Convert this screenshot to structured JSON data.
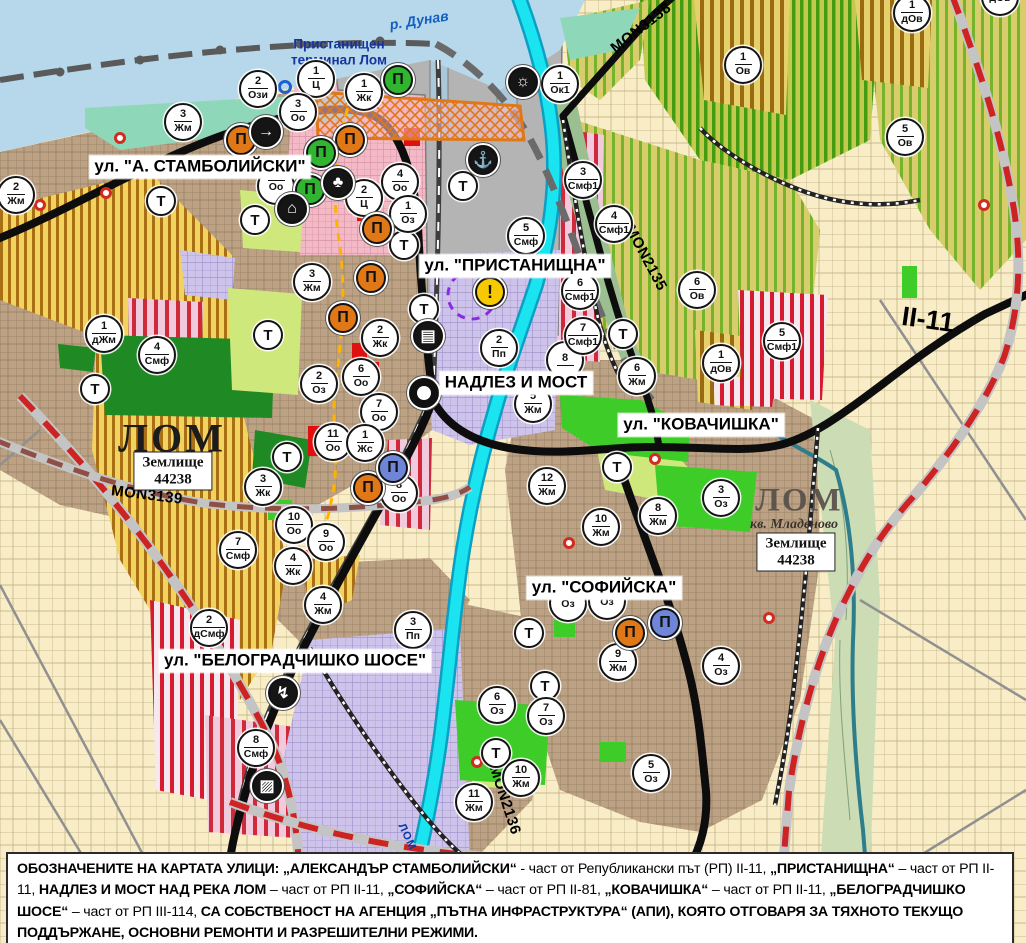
{
  "palette": {
    "water": "#b7d7ea",
    "mint": "#8fd7b9",
    "urban": "#bda185",
    "cream": "#f8edc6",
    "yellow_zone": "#f1d35e",
    "yellow_stripe": "#a86f14",
    "vine": "#d8cd6d",
    "vine_stripe": "#74b32a",
    "vine_dense": "#c3cb4f",
    "vine_dense_stripe": "#459b12",
    "red_stripe": "#d51b30",
    "pink": "#f3bac6",
    "lavender": "#cec3ea",
    "gray_port": "#b4b4b4",
    "park_dark": "#1f8a24",
    "green_bright": "#3ecc28",
    "green_light": "#cfe87c",
    "cyan_river": "#1ae4ef",
    "road_black": "#0d0d0d",
    "road_red_dash": "#ce2323",
    "road_brown_dash": "#8f4f45",
    "marker_orange": "#e07818",
    "marker_green": "#2fb52f",
    "marker_blue": "#6f86d8",
    "warning_yellow": "#f7c900"
  },
  "street_labels": [
    {
      "text": "ул. \"А. СТАМБОЛИЙСКИ\"",
      "x": 200,
      "y": 167
    },
    {
      "text": "ул. \"ПРИСТАНИЩНА\"",
      "x": 515,
      "y": 266
    },
    {
      "text": "НАДЛЕЗ И МОСТ",
      "x": 516,
      "y": 383
    },
    {
      "text": "ул. \"КОВАЧИШКА\"",
      "x": 701,
      "y": 425
    },
    {
      "text": "ул. \"СОФИЙСКА\"",
      "x": 604,
      "y": 588
    },
    {
      "text": "ул. \"БЕЛОГРАДЧИШКО ШОСЕ\"",
      "x": 295,
      "y": 661
    }
  ],
  "map_labels": [
    {
      "text": "р. Дунав",
      "x": 419,
      "y": 20,
      "rot": -9,
      "cls": "lbl-river",
      "name": "river-danube-label"
    },
    {
      "text": "Пристанищен\nтерминал Лом",
      "x": 339,
      "y": 52,
      "rot": 0,
      "cls": "lbl-port",
      "name": "port-terminal-label"
    },
    {
      "text": "MON3138",
      "x": 641,
      "y": 28,
      "rot": -38,
      "cls": "lbl-road",
      "name": "road-label-mon3138"
    },
    {
      "text": "MON2135",
      "x": 646,
      "y": 258,
      "rot": 62,
      "cls": "lbl-road",
      "name": "road-label-mon2135"
    },
    {
      "text": "MON3139",
      "x": 147,
      "y": 495,
      "rot": 7,
      "cls": "lbl-road",
      "name": "road-label-mon3139"
    },
    {
      "text": "MON2136",
      "x": 505,
      "y": 800,
      "rot": 72,
      "cls": "lbl-road",
      "name": "road-label-mon2136"
    },
    {
      "text": "II-11",
      "x": 928,
      "y": 320,
      "rot": 8,
      "cls": "lbl-road-big",
      "name": "road-label-ii-11"
    },
    {
      "text": "ЛОМ",
      "x": 172,
      "y": 438,
      "rot": 0,
      "cls": "lbl-city",
      "name": "city-label-lom"
    },
    {
      "text": "ЛОМ",
      "x": 799,
      "y": 501,
      "rot": 0,
      "cls": "lbl-city2",
      "name": "city-label-lom-mladenovo"
    },
    {
      "text": "кв. Младеново",
      "x": 794,
      "y": 525,
      "rot": 0,
      "cls": "lbl-kv",
      "name": "quarter-label-mladenovo"
    },
    {
      "text": "ЛОМ",
      "x": 407,
      "y": 837,
      "rot": 65,
      "cls": "lbl-riverlom",
      "name": "river-lom-label"
    }
  ],
  "zemlishte_boxes": [
    {
      "line1": "Землище",
      "line2": "44238",
      "x": 173,
      "y": 471
    },
    {
      "line1": "Землище",
      "line2": "44238",
      "x": 796,
      "y": 552
    }
  ],
  "zone_markers": [
    {
      "n": "2",
      "a": "Жм",
      "x": 16,
      "y": 195
    },
    {
      "n": "3",
      "a": "Жм",
      "x": 183,
      "y": 122
    },
    {
      "n": "2",
      "a": "Ози",
      "x": 258,
      "y": 89
    },
    {
      "n": "1",
      "a": "Ц",
      "x": 316,
      "y": 79
    },
    {
      "n": "1",
      "a": "Жк",
      "x": 364,
      "y": 92
    },
    {
      "n": "3",
      "a": "Оо",
      "x": 298,
      "y": 112
    },
    {
      "n": "4",
      "a": "Оо",
      "x": 400,
      "y": 182
    },
    {
      "n": "2",
      "a": "Ц",
      "x": 364,
      "y": 198
    },
    {
      "n": "1",
      "a": "Оз",
      "x": 408,
      "y": 214
    },
    {
      "n": "",
      "a": "Оо",
      "x": 276,
      "y": 186
    },
    {
      "n": "1",
      "a": "дЖм",
      "x": 104,
      "y": 334
    },
    {
      "n": "4",
      "a": "Смф",
      "x": 157,
      "y": 355
    },
    {
      "n": "3",
      "a": "Жм",
      "x": 312,
      "y": 282
    },
    {
      "n": "2",
      "a": "Жк",
      "x": 380,
      "y": 338
    },
    {
      "n": "6",
      "a": "Оо",
      "x": 361,
      "y": 377
    },
    {
      "n": "2",
      "a": "Оз",
      "x": 319,
      "y": 384
    },
    {
      "n": "7",
      "a": "Оо",
      "x": 379,
      "y": 412
    },
    {
      "n": "11",
      "a": "Оо",
      "x": 333,
      "y": 442
    },
    {
      "n": "1",
      "a": "Жс",
      "x": 365,
      "y": 443
    },
    {
      "n": "3",
      "a": "Жк",
      "x": 263,
      "y": 487
    },
    {
      "n": "8",
      "a": "Оо",
      "x": 399,
      "y": 493
    },
    {
      "n": "10",
      "a": "Оо",
      "x": 294,
      "y": 525
    },
    {
      "n": "9",
      "a": "Оо",
      "x": 326,
      "y": 542
    },
    {
      "n": "4",
      "a": "Жк",
      "x": 293,
      "y": 566
    },
    {
      "n": "7",
      "a": "Смф",
      "x": 238,
      "y": 550
    },
    {
      "n": "2",
      "a": "дСмф",
      "x": 209,
      "y": 628
    },
    {
      "n": "4",
      "a": "Жм",
      "x": 323,
      "y": 605
    },
    {
      "n": "3",
      "a": "Пп",
      "x": 413,
      "y": 630
    },
    {
      "n": "8",
      "a": "Смф",
      "x": 256,
      "y": 748
    },
    {
      "n": "5",
      "a": "Смф",
      "x": 526,
      "y": 236
    },
    {
      "n": "2",
      "a": "Пп",
      "x": 499,
      "y": 348
    },
    {
      "n": "8",
      "a": "",
      "x": 565,
      "y": 360
    },
    {
      "n": "5",
      "a": "Жм",
      "x": 533,
      "y": 404
    },
    {
      "n": "6",
      "a": "Жм",
      "x": 637,
      "y": 376
    },
    {
      "n": "12",
      "a": "Жм",
      "x": 547,
      "y": 486
    },
    {
      "n": "10",
      "a": "Жм",
      "x": 601,
      "y": 527
    },
    {
      "n": "8",
      "a": "Жм",
      "x": 658,
      "y": 516
    },
    {
      "n": "3",
      "a": "Оз",
      "x": 721,
      "y": 498
    },
    {
      "n": "",
      "a": "Оз",
      "x": 568,
      "y": 603
    },
    {
      "n": "",
      "a": "Оз",
      "x": 607,
      "y": 601
    },
    {
      "n": "9",
      "a": "Жм",
      "x": 618,
      "y": 662
    },
    {
      "n": "4",
      "a": "Оз",
      "x": 721,
      "y": 666
    },
    {
      "n": "6",
      "a": "Оз",
      "x": 497,
      "y": 705
    },
    {
      "n": "7",
      "a": "Оз",
      "x": 546,
      "y": 716
    },
    {
      "n": "10",
      "a": "Жм",
      "x": 521,
      "y": 778
    },
    {
      "n": "11",
      "a": "Жм",
      "x": 474,
      "y": 802
    },
    {
      "n": "5",
      "a": "Оз",
      "x": 651,
      "y": 773
    },
    {
      "n": "1",
      "a": "Ок1",
      "x": 560,
      "y": 84
    },
    {
      "n": "3",
      "a": "Смф1",
      "x": 583,
      "y": 180
    },
    {
      "n": "4",
      "a": "Смф1",
      "x": 614,
      "y": 224
    },
    {
      "n": "6",
      "a": "Смф1",
      "x": 580,
      "y": 291
    },
    {
      "n": "7",
      "a": "Смф1",
      "x": 583,
      "y": 336
    },
    {
      "n": "5",
      "a": "Смф1",
      "x": 782,
      "y": 341
    },
    {
      "n": "6",
      "a": "Ов",
      "x": 697,
      "y": 290
    },
    {
      "n": "1",
      "a": "дОв",
      "x": 721,
      "y": 363
    },
    {
      "n": "1",
      "a": "Ов",
      "x": 743,
      "y": 65
    },
    {
      "n": "5",
      "a": "Ов",
      "x": 905,
      "y": 137
    },
    {
      "n": "1",
      "a": "дОв",
      "x": 912,
      "y": 13
    },
    {
      "n": "",
      "a": "дОв",
      "x": 1000,
      "y": -3
    }
  ],
  "t_markers": [
    {
      "x": 161,
      "y": 201
    },
    {
      "x": 255,
      "y": 220
    },
    {
      "x": 268,
      "y": 335
    },
    {
      "x": 95,
      "y": 389
    },
    {
      "x": 287,
      "y": 457
    },
    {
      "x": 404,
      "y": 245
    },
    {
      "x": 424,
      "y": 309
    },
    {
      "x": 463,
      "y": 186
    },
    {
      "x": 623,
      "y": 334
    },
    {
      "x": 617,
      "y": 467
    },
    {
      "x": 529,
      "y": 633
    },
    {
      "x": 545,
      "y": 686
    },
    {
      "x": 496,
      "y": 753
    }
  ],
  "poi_icons": [
    {
      "kind": "landmark",
      "variant": "orange",
      "x": 241,
      "y": 140
    },
    {
      "kind": "landmark",
      "variant": "orange",
      "x": 350,
      "y": 140
    },
    {
      "kind": "landmark",
      "variant": "orange",
      "x": 377,
      "y": 229
    },
    {
      "kind": "landmark",
      "variant": "orange",
      "x": 371,
      "y": 278
    },
    {
      "kind": "landmark",
      "variant": "orange",
      "x": 343,
      "y": 318
    },
    {
      "kind": "landmark",
      "variant": "orange",
      "x": 368,
      "y": 488
    },
    {
      "kind": "landmark",
      "variant": "orange",
      "x": 630,
      "y": 633
    },
    {
      "kind": "landmark",
      "variant": "green",
      "x": 398,
      "y": 80
    },
    {
      "kind": "landmark",
      "variant": "green",
      "x": 321,
      "y": 153
    },
    {
      "kind": "landmark",
      "variant": "green",
      "x": 310,
      "y": 190
    },
    {
      "kind": "landmark",
      "variant": "blue",
      "x": 393,
      "y": 468
    },
    {
      "kind": "landmark",
      "variant": "blue",
      "x": 665,
      "y": 623
    },
    {
      "kind": "key",
      "variant": "black",
      "x": 266,
      "y": 132
    },
    {
      "kind": "trefoil",
      "variant": "black",
      "x": 338,
      "y": 183
    },
    {
      "kind": "mountain",
      "variant": "black",
      "x": 292,
      "y": 209
    },
    {
      "kind": "anchor",
      "variant": "black",
      "x": 483,
      "y": 160
    },
    {
      "kind": "sun",
      "variant": "black",
      "x": 523,
      "y": 82
    },
    {
      "kind": "bus",
      "variant": "black",
      "x": 428,
      "y": 336
    },
    {
      "kind": "lightning",
      "variant": "black",
      "x": 283,
      "y": 693
    },
    {
      "kind": "railcross",
      "variant": "black",
      "x": 267,
      "y": 786
    },
    {
      "kind": "warning",
      "variant": "warning",
      "x": 490,
      "y": 292
    },
    {
      "kind": "junction",
      "variant": "junction",
      "x": 424,
      "y": 393
    }
  ],
  "red_dots": [
    {
      "x": 120,
      "y": 138
    },
    {
      "x": 106,
      "y": 193
    },
    {
      "x": 40,
      "y": 205
    },
    {
      "x": 655,
      "y": 459
    },
    {
      "x": 569,
      "y": 543
    },
    {
      "x": 477,
      "y": 762
    },
    {
      "x": 769,
      "y": 618
    },
    {
      "x": 984,
      "y": 205
    }
  ],
  "blue_rings": [
    {
      "x": 285,
      "y": 87
    }
  ],
  "note": {
    "segments": [
      {
        "text": "ОБОЗНАЧЕНИТЕ НА КАРТАТА УЛИЦИ: „АЛЕКСАНДЪР СТАМБОЛИЙСКИ“",
        "bold": true
      },
      {
        "text": " - част от Републикански път (РП) II-11, ",
        "bold": false
      },
      {
        "text": "„ПРИСТАНИЩНА“",
        "bold": true
      },
      {
        "text": " – част от РП II-11, ",
        "bold": false
      },
      {
        "text": "НАДЛЕЗ И МОСТ НАД РЕКА ЛОМ",
        "bold": true
      },
      {
        "text": " – част от РП II-11, ",
        "bold": false
      },
      {
        "text": "„СОФИЙСКА“",
        "bold": true
      },
      {
        "text": " – част от РП II-81, ",
        "bold": false
      },
      {
        "text": "„КОВАЧИШКА“",
        "bold": true
      },
      {
        "text": " – част от РП II-11, ",
        "bold": false
      },
      {
        "text": "„БЕЛОГРАДЧИШКО ШОСЕ“",
        "bold": true
      },
      {
        "text": " – част от РП III-114, ",
        "bold": false
      },
      {
        "text": "СА СОБСТВЕНОСТ НА АГЕНЦИЯ „ПЪТНА ИНФРАСТРУКТУРА“ (АПИ), КОЯТО ОТГОВАРЯ ЗА ТЯХНОТО ТЕКУЩО ПОДДЪРЖАНЕ, ОСНОВНИ РЕМОНТИ И РАЗРЕШИТЕЛНИ РЕЖИМИ.",
        "bold": true
      }
    ]
  }
}
